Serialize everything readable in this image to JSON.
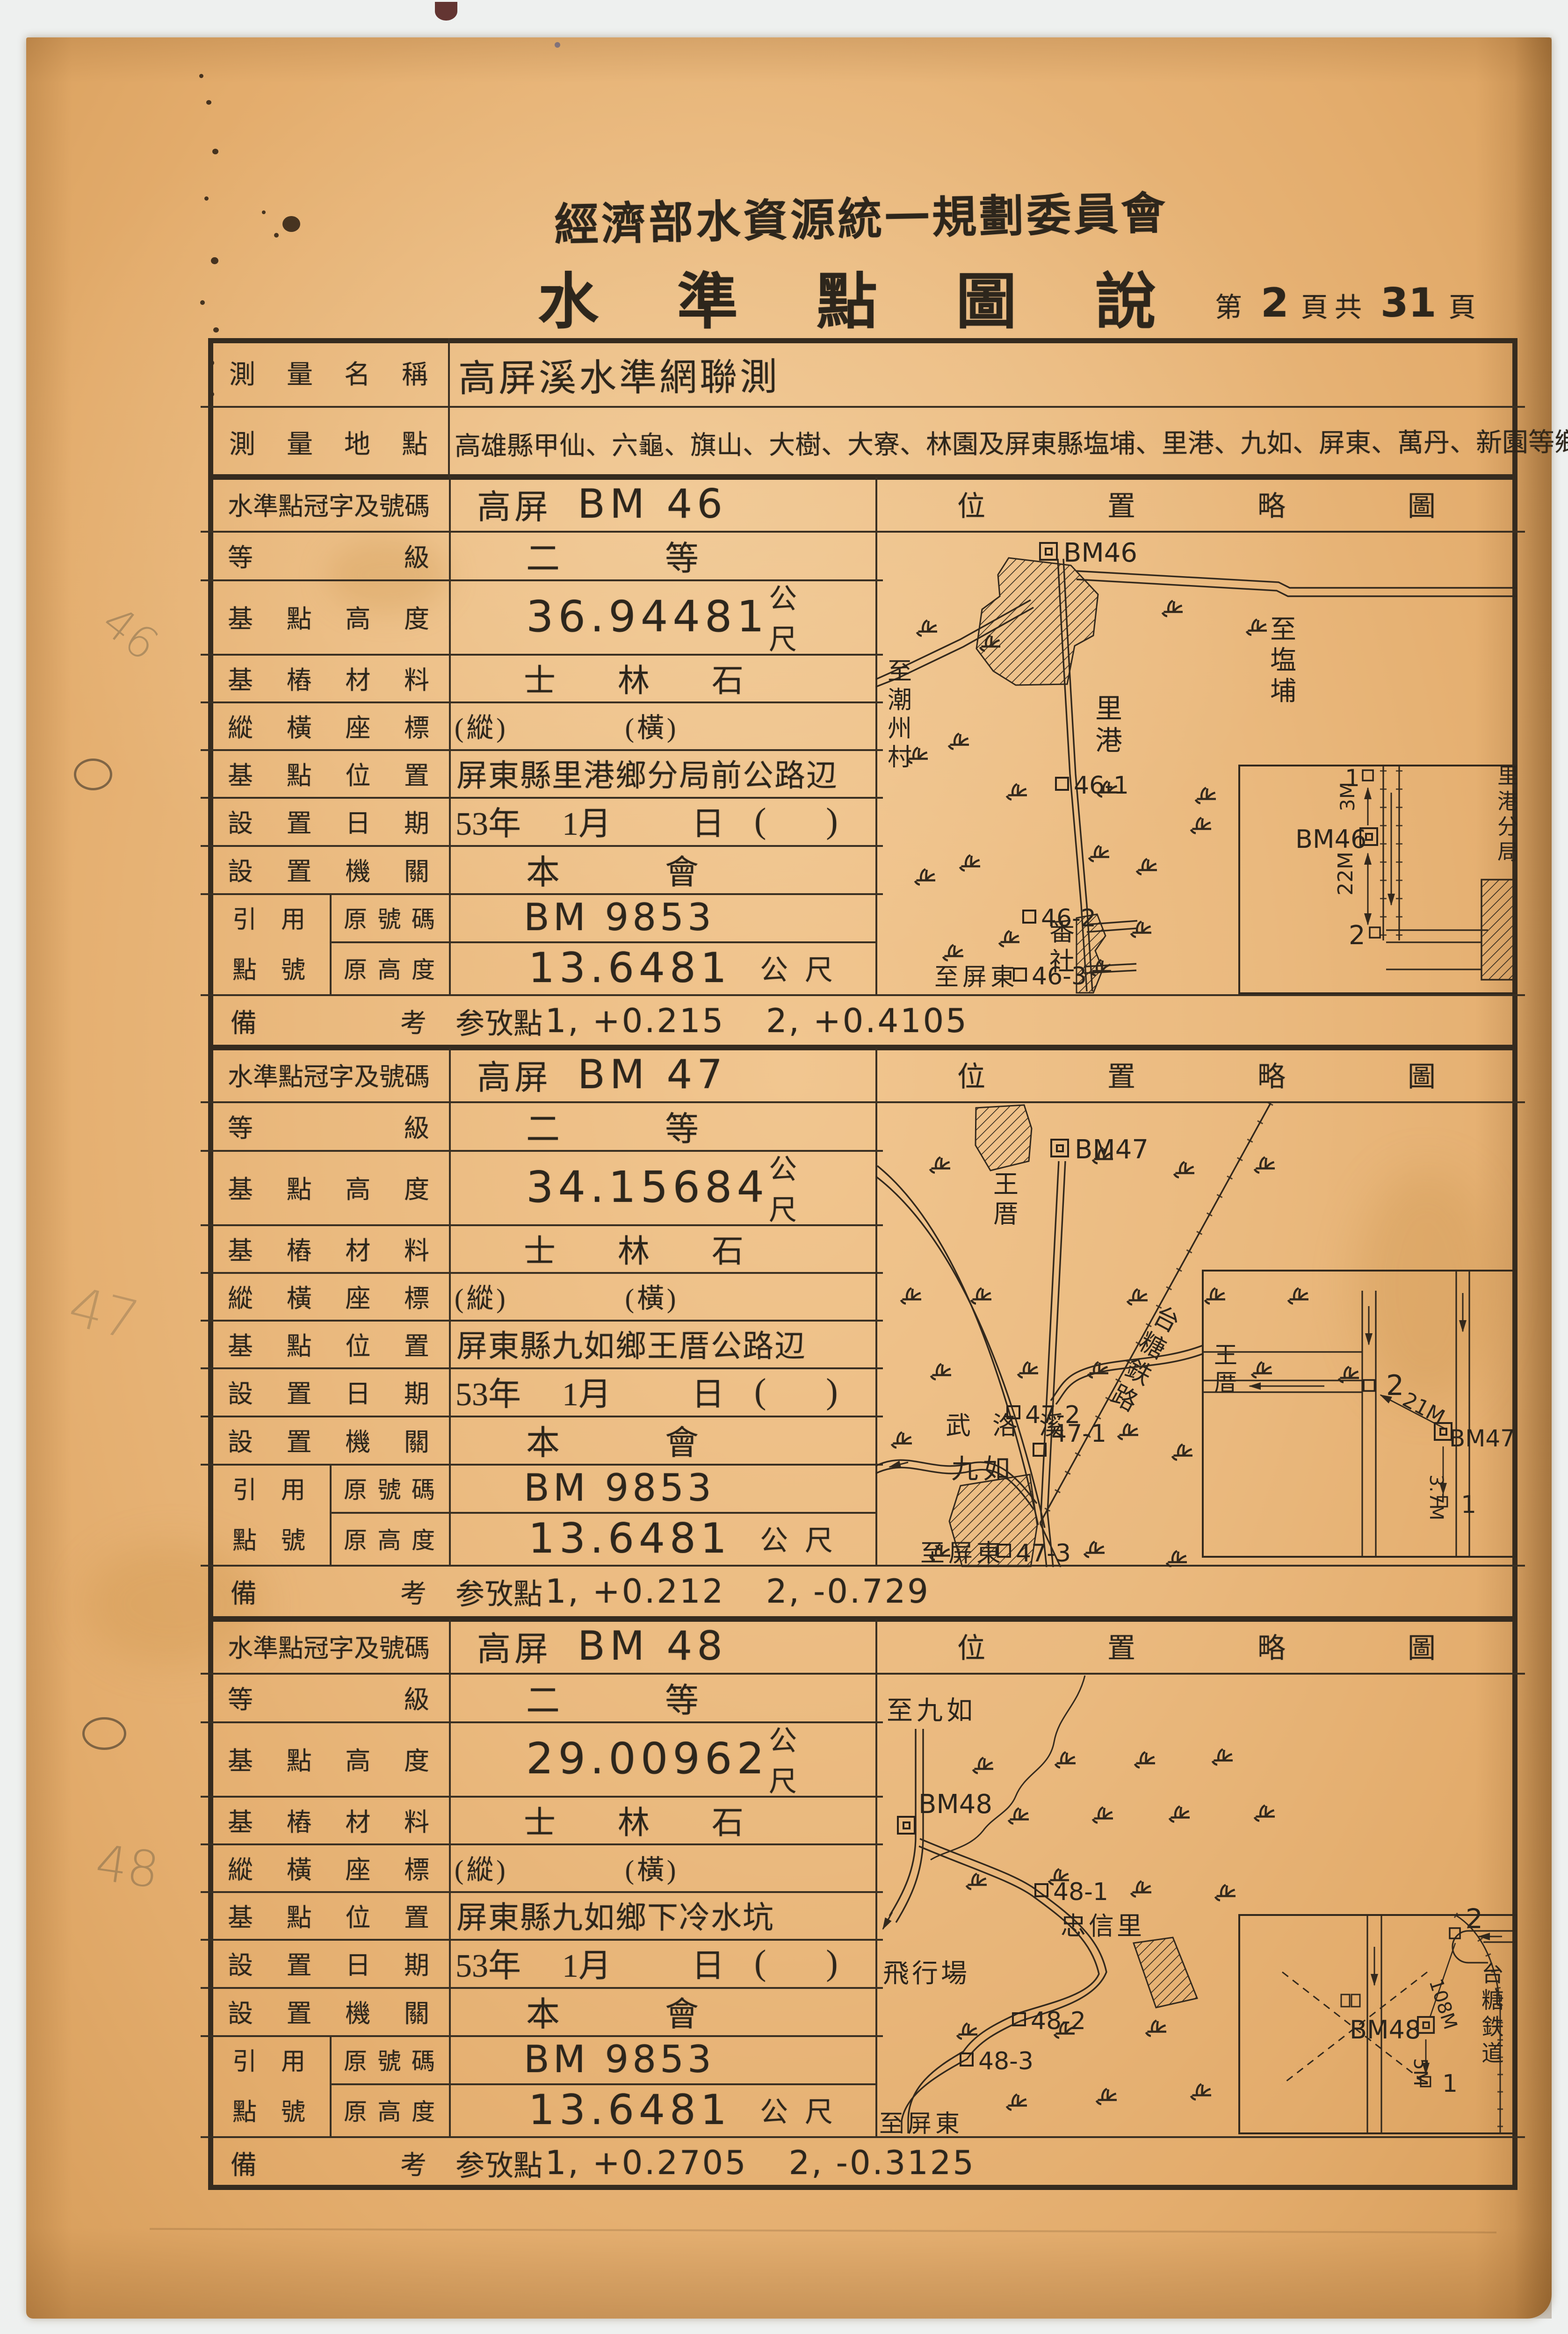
{
  "page": {
    "org": "經濟部水資源統一規劃委員會",
    "title": "水準點圖說",
    "page_no": {
      "prefix": "第",
      "num": "2",
      "mid": "頁共",
      "total": "31",
      "suffix": "頁"
    }
  },
  "labels": {
    "survey_name": "測量名稱",
    "survey_area": "測量地點",
    "bm_id": "水準點冠字及號碼",
    "grade": "等級",
    "height": "基點高度",
    "material": "基樁材料",
    "coords": "縱橫座標",
    "location": "基點位置",
    "date": "設置日期",
    "agency": "設置機關",
    "ref_a": "引用",
    "ref_b": "點號",
    "ref_no": "原號碼",
    "ref_height": "原高度",
    "remark_a": "備",
    "remark_b": "考",
    "map_title": "位置略圖",
    "unit": "公尺"
  },
  "header": {
    "name": "高屏溪水準網聯測",
    "area": "高雄縣甲仙、六龜、旗山、大樹、大寮、林園及屏東縣塩埔、里港、九如、屏東、萬丹、新園等鄉鎮市"
  },
  "sections": [
    {
      "id_prefix": "高屏",
      "id_no": "BM 46",
      "grade_1": "二",
      "grade_2": "等",
      "height": "36.94481",
      "material": "士林石",
      "coord_v": "(縱)",
      "coord_h": "(橫)",
      "location": "屏東縣里港鄉分局前公路辺",
      "date_y": "53年",
      "date_m": "1月",
      "date_d": "日",
      "date_p1": "(",
      "date_p2": ")",
      "agency_1": "本",
      "agency_2": "會",
      "ref_no": "BM 9853",
      "ref_height": "13.6481",
      "remark_label": "参攷點",
      "remark_1": "1, +0.215",
      "remark_2": "2, +0.4105",
      "map": {
        "bm": "BM46",
        "p1": "46-1",
        "p2": "46-2",
        "p3": "46-3",
        "town": "里港",
        "town2": "番社",
        "dir_left": "至潮州村",
        "dir_right": "至塩埔",
        "dir_bottom": "至屏東",
        "inset": {
          "n1": "1",
          "n2": "2",
          "d1": "3M",
          "d2": "22M",
          "bm": "BM46",
          "place": "里港分局"
        }
      }
    },
    {
      "id_prefix": "高屏",
      "id_no": "BM 47",
      "grade_1": "二",
      "grade_2": "等",
      "height": "34.15684",
      "material": "士林石",
      "coord_v": "(縱)",
      "coord_h": "(橫)",
      "location": "屏東縣九如鄉王厝公路辺",
      "date_y": "53年",
      "date_m": "1月",
      "date_d": "日",
      "date_p1": "(",
      "date_p2": ")",
      "agency_1": "本",
      "agency_2": "會",
      "ref_no": "BM 9853",
      "ref_height": "13.6481",
      "remark_label": "参攷點",
      "remark_1": "1, +0.212",
      "remark_2": "2, -0.729",
      "map": {
        "bm": "BM47",
        "p1": "47-1",
        "p2": "47-2",
        "p3": "47-3",
        "town": "九如",
        "town2": "王厝",
        "river": "武洛溪",
        "railway": "台糖鉄路",
        "dir_bottom": "至屏東",
        "inset": {
          "n1": "1",
          "n2": "2",
          "d1": "21M",
          "d2": "3.7M",
          "bm": "BM47",
          "place": "王厝"
        }
      }
    },
    {
      "id_prefix": "高屏",
      "id_no": "BM 48",
      "grade_1": "二",
      "grade_2": "等",
      "height": "29.00962",
      "material": "士林石",
      "coord_v": "(縱)",
      "coord_h": "(橫)",
      "location": "屏東縣九如鄉下冷水坑",
      "date_y": "53年",
      "date_m": "1月",
      "date_d": "日",
      "date_p1": "(",
      "date_p2": ")",
      "agency_1": "本",
      "agency_2": "會",
      "ref_no": "BM 9853",
      "ref_height": "13.6481",
      "remark_label": "参攷點",
      "remark_1": "1, +0.2705",
      "remark_2": "2, -0.3125",
      "map": {
        "bm": "BM48",
        "p1": "48-1",
        "p2": "48-2",
        "p3": "48-3",
        "town": "忠信里",
        "airfield": "飛行場",
        "dir_top": "至九如",
        "dir_bottom": "至屏東",
        "inset": {
          "n1": "1",
          "n2": "2",
          "d1": "5M",
          "d2": "108M",
          "bm": "BM48",
          "railway": "台糖鉄道"
        }
      }
    }
  ],
  "margin": {
    "pencil_1": "46",
    "pencil_2": "47",
    "pencil_3": "48"
  }
}
